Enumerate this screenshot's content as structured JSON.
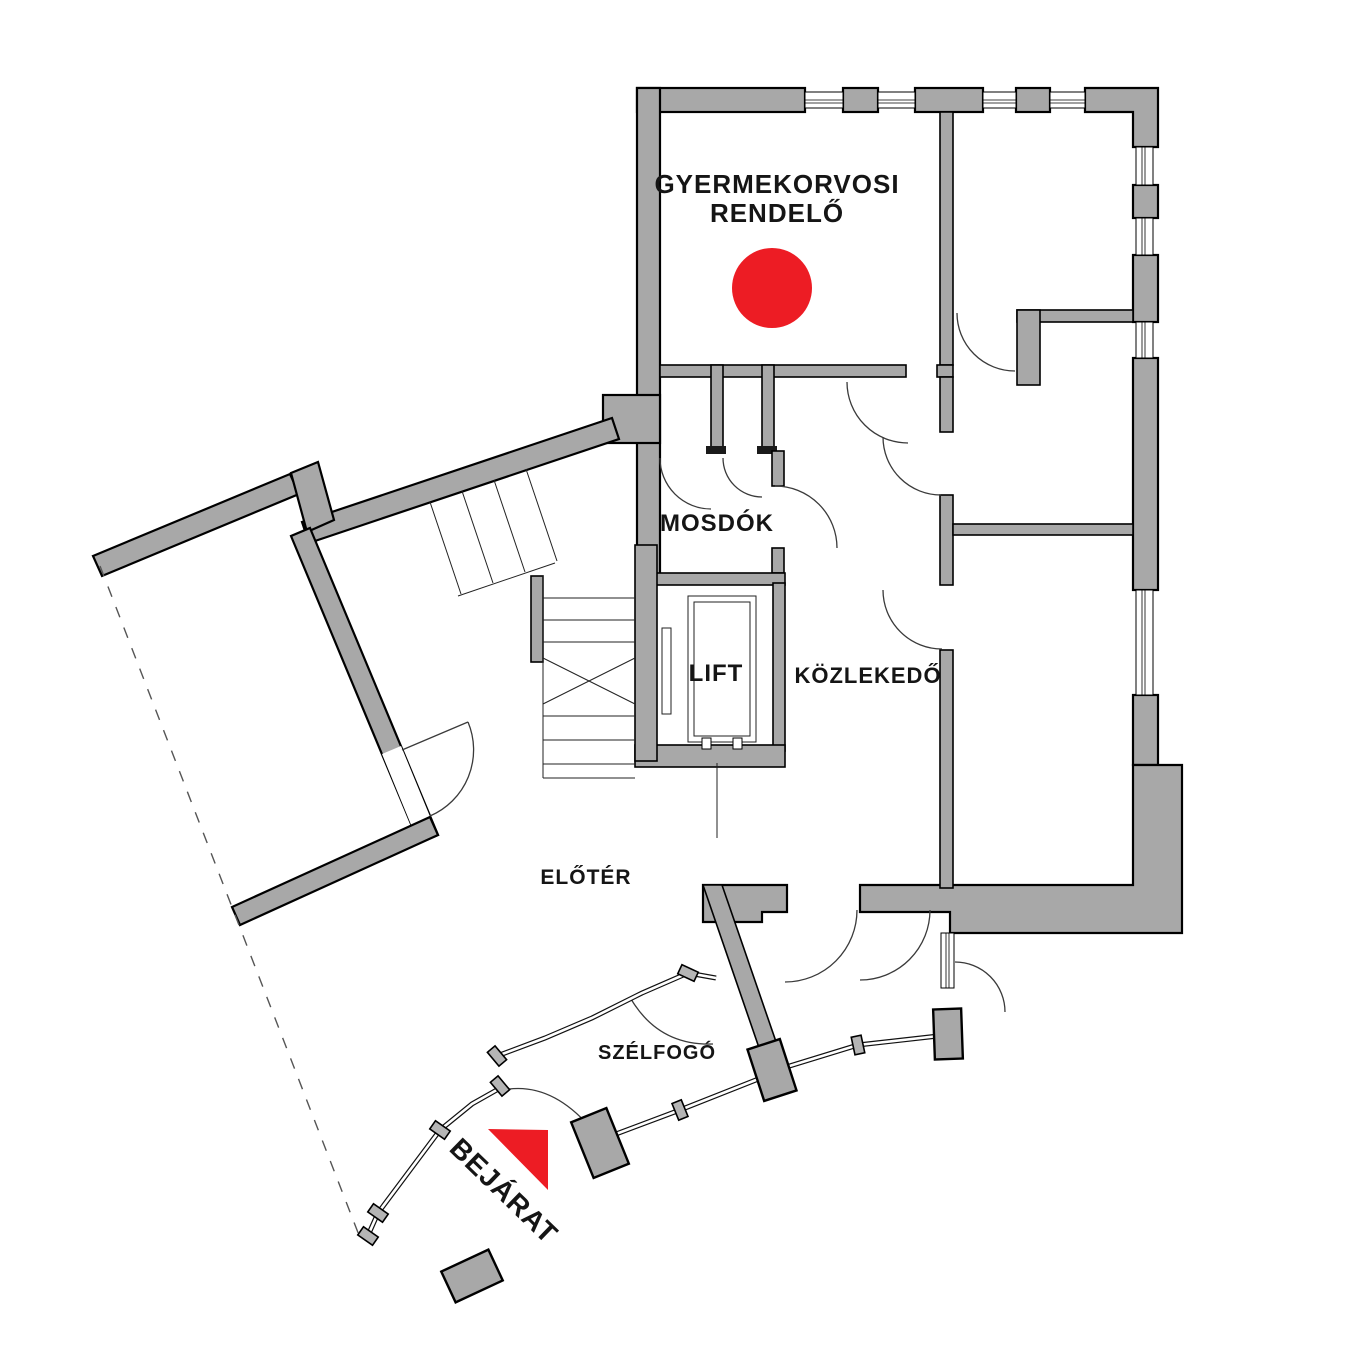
{
  "title": "Gyermekorvosi rendelő alaprajz",
  "colors": {
    "wall_gray": "#a8a8a8",
    "line_black": "#000000",
    "marker_red": "#ed1c24",
    "background": "#ffffff"
  },
  "labels": {
    "clinic_line1": "GYERMEKORVOSI",
    "clinic_line2": "RENDELŐ",
    "washrooms": "MOSDÓK",
    "lift": "LIFT",
    "corridor": "KÖZLEKEDŐ",
    "foyer": "ELŐTÉR",
    "windbreak": "SZÉLFOGÓ",
    "entrance": "BEJÁRAT"
  },
  "markers": {
    "room_marker": {
      "icon": "red-circle",
      "room": "GYERMEKORVOSI RENDELŐ"
    },
    "entrance_arrow": {
      "icon": "red-triangle",
      "points_to": "BEJÁRAT"
    }
  }
}
